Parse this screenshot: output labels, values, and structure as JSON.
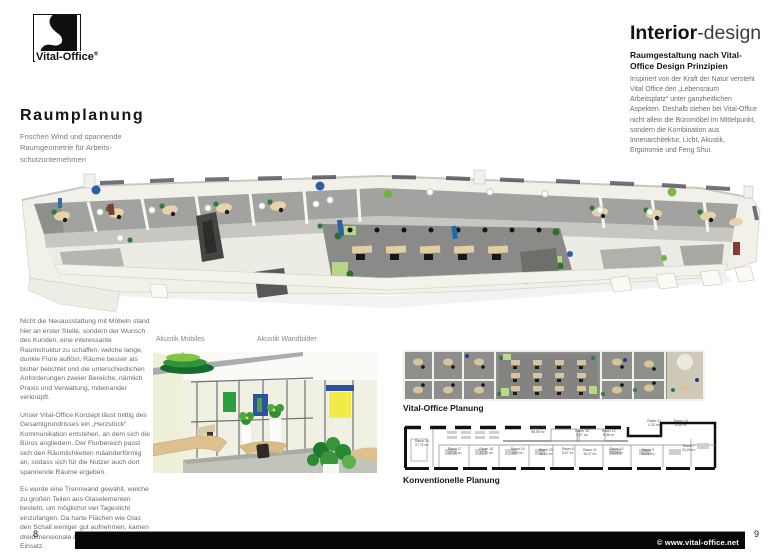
{
  "brand": {
    "name": "Vital-Office",
    "registered": "®"
  },
  "left_column": {
    "heading": "Raumplanung",
    "subtitle": "Frischen Wind und spannende\nRaumgeometrie für Arbeits-\nschutzunternehmen",
    "paragraphs": [
      "Nicht die Neuausstattung mit Möbeln stand hier an erster Stelle, sondern der Wunsch des Kunden, eine interessante Raumstruktur zu schaffen, welche lange, dunkle Flure auflöst, Räume besser als bisher belichtet und die unterschiedlichen Anforderungen zweier Bereiche, nämlich Praxis und Verwaltung, miteinander verknüpft.",
      "Unser Vital-Office Konzept lässt mittig des Gesamtgrundrisses ein „Herzstück“ Kommunikation entstehen, an dem sich die Büros angliedern. Der Flurbereich passt sich den Räumlichkeiten mäanderförmig an, sodass sich für die Nutzer auch dort spannende Räume ergeben.",
      "Es wurde eine Trennwand gewählt, welche zu großen Teilen aus Glaselementen besteht, um möglichst viel Tageslicht einzufangen. Da harte Flächen wie Glas den Schall weniger gut aufnehmen, kamen dreidimensionale Akustikmobiles zum Einsatz."
    ]
  },
  "right_column": {
    "heading_strong": "Interior",
    "heading_light": "-design",
    "subheading": "Raumgestaltung nach Vital-Office Design Prinzipien",
    "body": "Inspiriert von der Kraft der Natur versteht Vital Office den „Lebensraum Arbeitsplatz“ unter ganzheitlichen Aspekten. Deshalb stehen bei Vital-Office nicht allein die Büromöbel im Mittelpunkt, sondern die Kombination aus Innenarchitektur, Licht, Akustik, Ergonomie und Feng Shui."
  },
  "captions": {
    "akustik_mobiles": "Akustik Mobiles",
    "akustik_wandbilder": "Akustik Wandbilder",
    "vital_office_planung": "Vital-Office Planung",
    "konventionelle_planung": "Konventionelle Planung"
  },
  "conventional_plan": {
    "rooms": [
      {
        "name": "Raum 16",
        "area": "27,71 m²",
        "x": 6,
        "y": 48
      },
      {
        "name": "Raum 17",
        "area": "17,71 m²",
        "x": 16.5,
        "y": 62
      },
      {
        "name": "Raum 18",
        "area": "17,71 m²",
        "x": 26.5,
        "y": 62
      },
      {
        "name": "Raum 19",
        "area": "16,9 m²",
        "x": 36.5,
        "y": 62
      },
      {
        "name": "Raum 20",
        "area": "10,02 m²",
        "x": 45.5,
        "y": 64
      },
      {
        "name": "Raum 8",
        "area": "8,67 m²",
        "x": 52.5,
        "y": 62
      },
      {
        "name": "Raum 11",
        "area": "16,47 m²",
        "x": 59.5,
        "y": 64
      },
      {
        "name": "Raum 10",
        "area": "13,04 m²",
        "x": 68,
        "y": 62
      },
      {
        "name": "Raum 9",
        "area": "14,21 m²",
        "x": 78,
        "y": 64
      },
      {
        "name": "Raum 7",
        "area": "24,20 m²",
        "x": 91,
        "y": 56
      },
      {
        "name": "Raum 15",
        "area": "96,55 m²",
        "x": 43,
        "y": 22
      },
      {
        "name": "Raum 13",
        "area": "2,07 m²",
        "x": 57,
        "y": 28
      },
      {
        "name": "Raum 12",
        "area": "5,36 m²",
        "x": 65.5,
        "y": 28
      },
      {
        "name": "Raum 21",
        "area": "0,32 m²",
        "x": 80,
        "y": 10
      },
      {
        "name": "Raum 14",
        "area": "4,36 m²",
        "x": 88.5,
        "y": 10
      }
    ]
  },
  "footer": {
    "copyright": "© www.vital-office.net",
    "page_left": "8",
    "page_right": "9"
  },
  "colors": {
    "accent_green": "#6db33f",
    "dark_green": "#1c6b2e",
    "accent_blue": "#2b52a0",
    "accent_yellow": "#f1ea49",
    "floor_gray": "#8a8a88",
    "desk_tan": "#e7d2a9"
  }
}
